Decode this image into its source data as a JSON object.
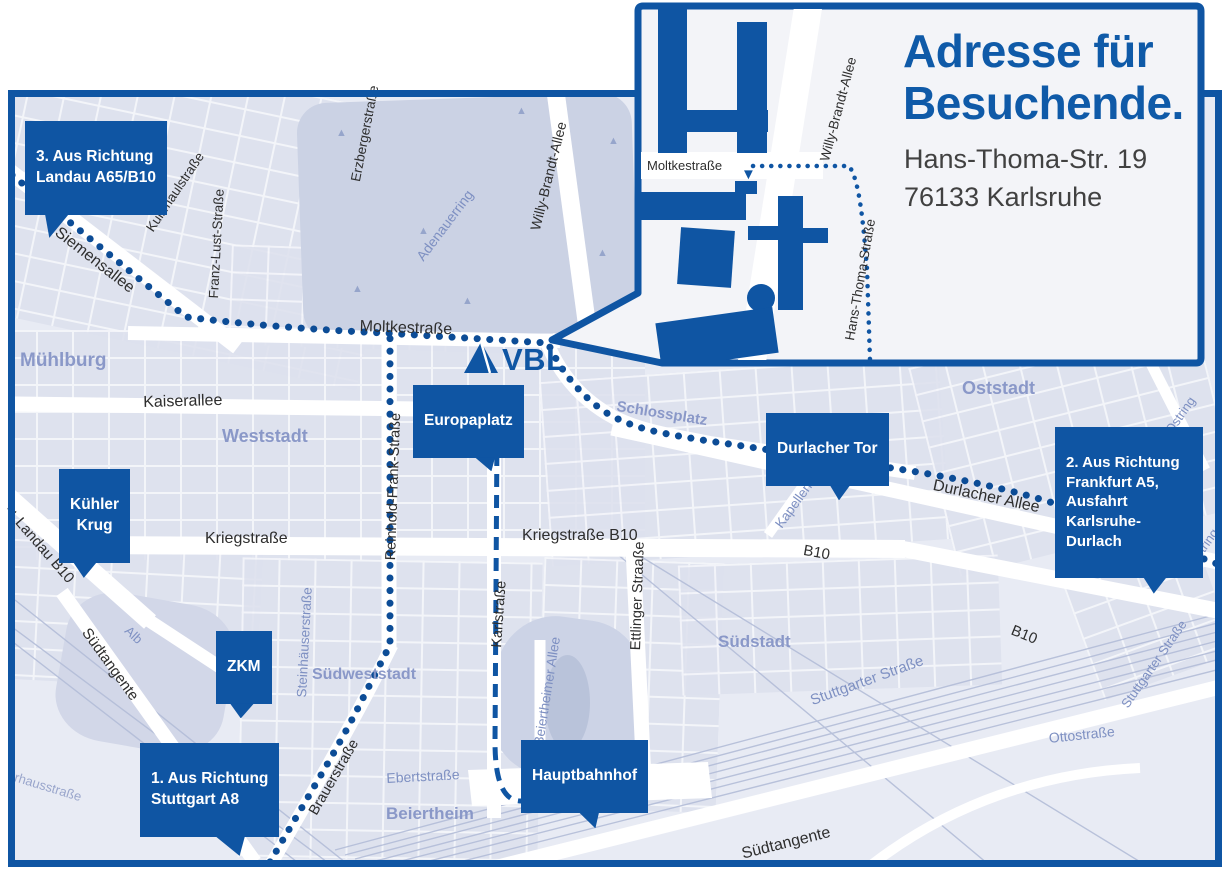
{
  "logo": {
    "text": "VBL"
  },
  "inset": {
    "title": "Adresse für\nBesuchende.",
    "address": "Hans-Thoma-Str. 19\n76133 Karlsruhe",
    "streets": {
      "moltkestrasse": "Moltkestraße",
      "willy_brandt_allee": "Willy-Brandt-Allee",
      "hans_thoma_strasse": "Hans-Thoma-Straße"
    }
  },
  "badges": {
    "route3": "3. Aus Richtung\nLandau A65/B10",
    "route2": "2. Aus Richtung\nFrankfurt A5,\nAusfahrt\nKarlsruhe-Durlach",
    "route1": "1. Aus Richtung\nStuttgart A8",
    "kuehler_krug": "Kühler\nKrug",
    "zkm": "ZKM",
    "europaplatz": "Europaplatz",
    "durlacher_tor": "Durlacher Tor",
    "hauptbahnhof": "Hauptbahnhof"
  },
  "streets": {
    "siemensallee": "Siemensallee",
    "kussmaulstrasse": "Kußmaulstraße",
    "franz_lust_strasse": "Franz-Lust-Straße",
    "erzbergerstrasse": "Erzbergerstraße",
    "adenauerring": "Adenauerring",
    "willy_brandt_allee": "Willy-Brandt-Allee",
    "moltkestrasse": "Moltkestraße",
    "kaiserallee": "Kaiserallee",
    "reinhold_frank_strasse": "Reinhold-Frank-Straße",
    "landau_b10": "Landau B10",
    "kriegstrasse": "Kriegstraße",
    "kriegstrasse_b10": "Kriegstraße B10",
    "karlstrasse": "Karlstraße",
    "ettlinger_strasse": "Ettlinger Straaße",
    "kapellenstrasse": "Kapellenstraße",
    "durlacher_allee": "Durlacher Allee",
    "ostring": "Ostring",
    "b10": "B10",
    "suedtangente": "Südtangente",
    "alb": "Alb",
    "steinhaeuserstrasse": "Steinhäuserstraße",
    "brauerstrasse": "Brauerstraße",
    "beiertheimer_allee": "Beiertheimer Allee",
    "ebertstrasse": "Ebertstraße",
    "stuttgarter_strasse": "Stuttgarter Straße",
    "ottostrasse": "Ottostraße",
    "pulverhausstrasse": "Pulverhausstraße"
  },
  "districts": {
    "muehlburg": "Mühlburg",
    "weststadt": "Weststadt",
    "oststadt": "Oststadt",
    "schlossplatz": "Schlossplatz",
    "suedstadt": "Südstadt",
    "suedweststadt": "Südweststadt",
    "beiertheim": "Beiertheim"
  },
  "icons": {
    "landau_arrow": "◄",
    "route_arrow": "▼",
    "tree": "▲"
  },
  "colors": {
    "primary_blue": "#0f55a3",
    "route_dot_blue": "#0c4c96",
    "map_background": "#e8ebf4",
    "block_fill": "#dde1ee",
    "park_fill": "#cbd2e4",
    "district_label": "#8695c7",
    "street_label": "#2e2e2e",
    "railway": "#b3bdd8",
    "inset_background": "#f3f4f8"
  }
}
